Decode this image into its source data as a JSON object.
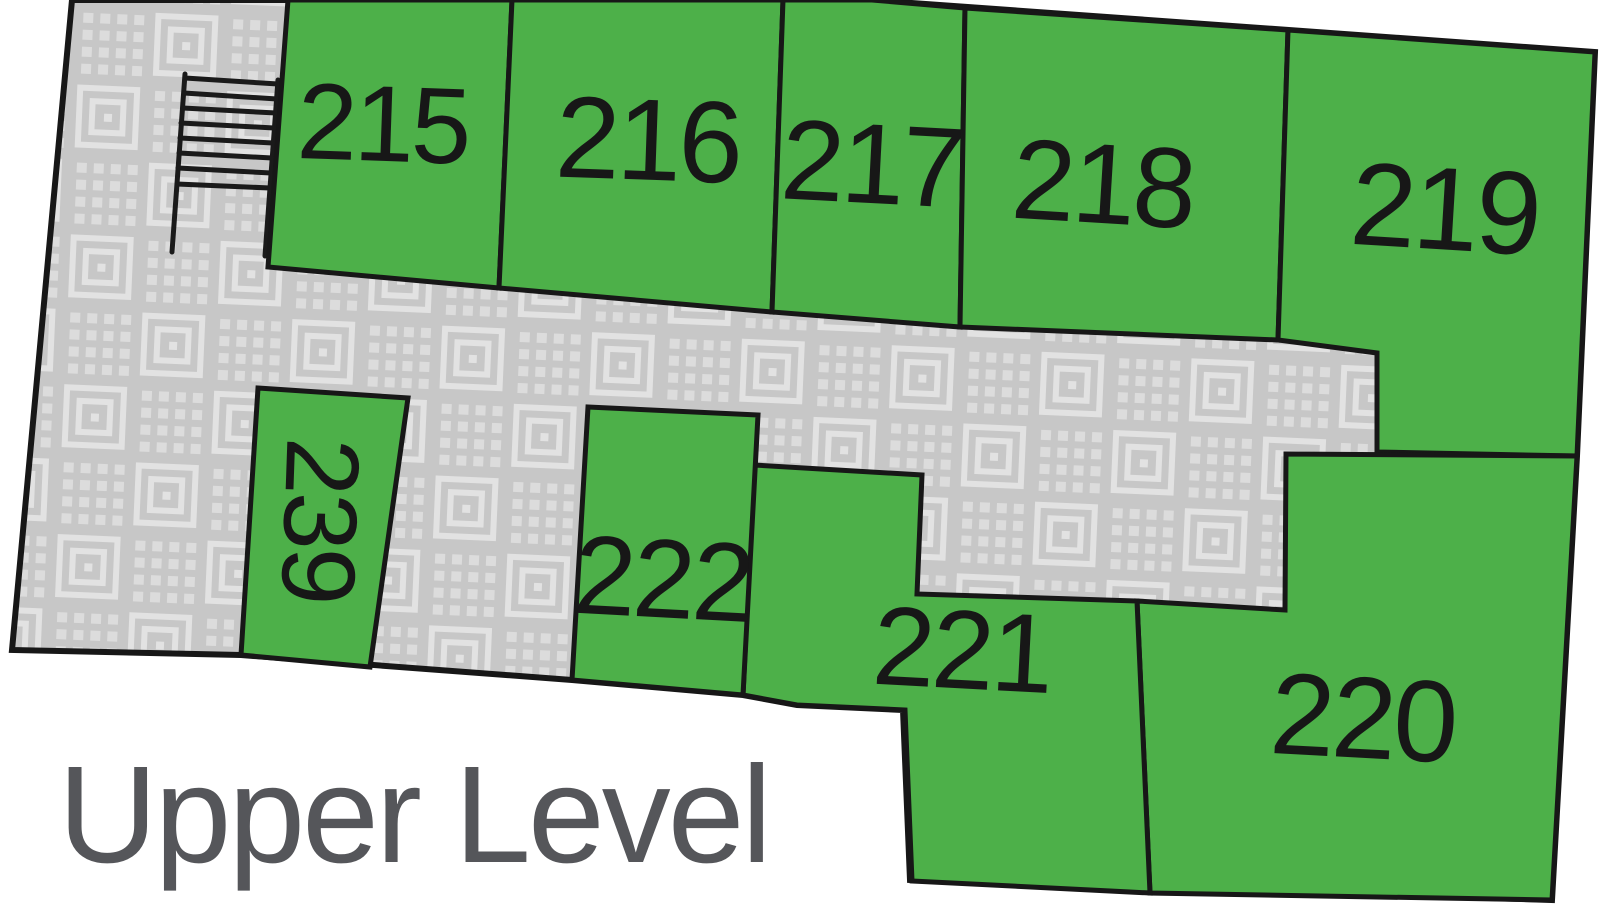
{
  "title": {
    "text": "Upper Level"
  },
  "rooms": [
    {
      "label": "215"
    },
    {
      "label": "216"
    },
    {
      "label": "217"
    },
    {
      "label": "218"
    },
    {
      "label": "219"
    },
    {
      "label": "220"
    },
    {
      "label": "221"
    },
    {
      "label": "222"
    },
    {
      "label": "239",
      "orientation": "vertical"
    }
  ],
  "icons": {
    "stairs": "stairs-icon"
  },
  "colors": {
    "room_fill": "#4db049",
    "wall": "#171717",
    "hallway_base": "#c7c7c7",
    "hallway_motif": "#e2e2e2",
    "hallway_dots": "#dcdcdc",
    "room_label": "#171717",
    "title_text": "#55565a",
    "background": "#ffffff"
  }
}
